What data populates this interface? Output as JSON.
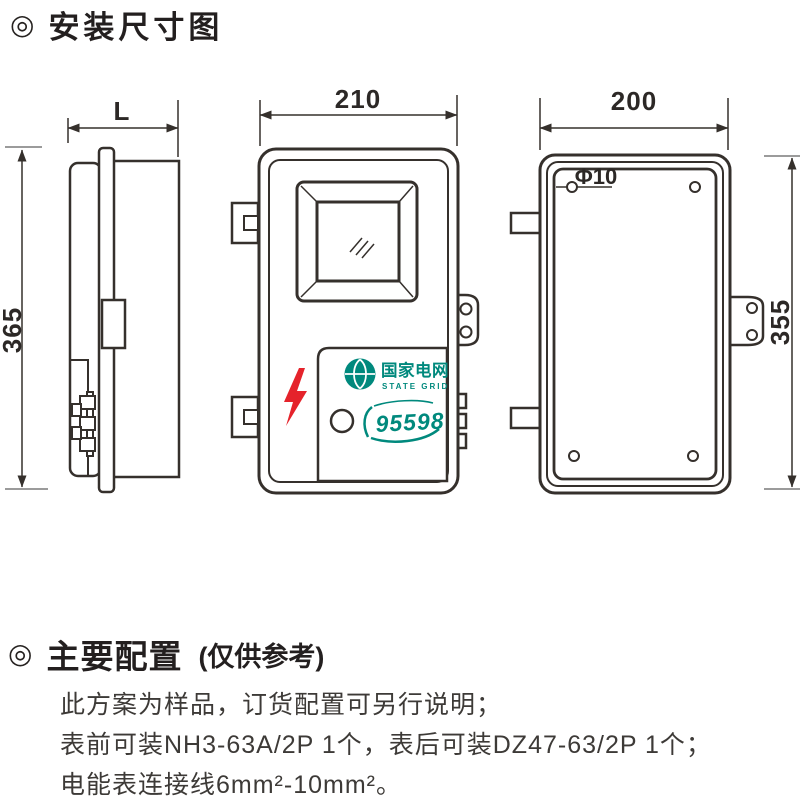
{
  "page": {
    "title_bullet": "◎",
    "title": "安装尺寸图",
    "section2_bullet": "◎",
    "section2_title": "主要配置",
    "section2_note": "(仅供参考)",
    "config_lines": [
      "此方案为样品，订货配置可另行说明；",
      "表前可装NH3-63A/2P 1个，表后可装DZ47-63/2P 1个；",
      "电能表连接线6mm²-10mm²。"
    ]
  },
  "diagram": {
    "side_view": {
      "width_label": "L",
      "height_label": "365"
    },
    "front_view": {
      "width_label": "210",
      "brand": "国家电网",
      "brand_sub": "STATE GRID",
      "hotline": "95598"
    },
    "back_view": {
      "width_label": "200",
      "height_label": "355",
      "hole_label": "Φ10"
    }
  },
  "colors": {
    "line": "#35302c",
    "teal": "#00897d",
    "red": "#e5232b"
  }
}
